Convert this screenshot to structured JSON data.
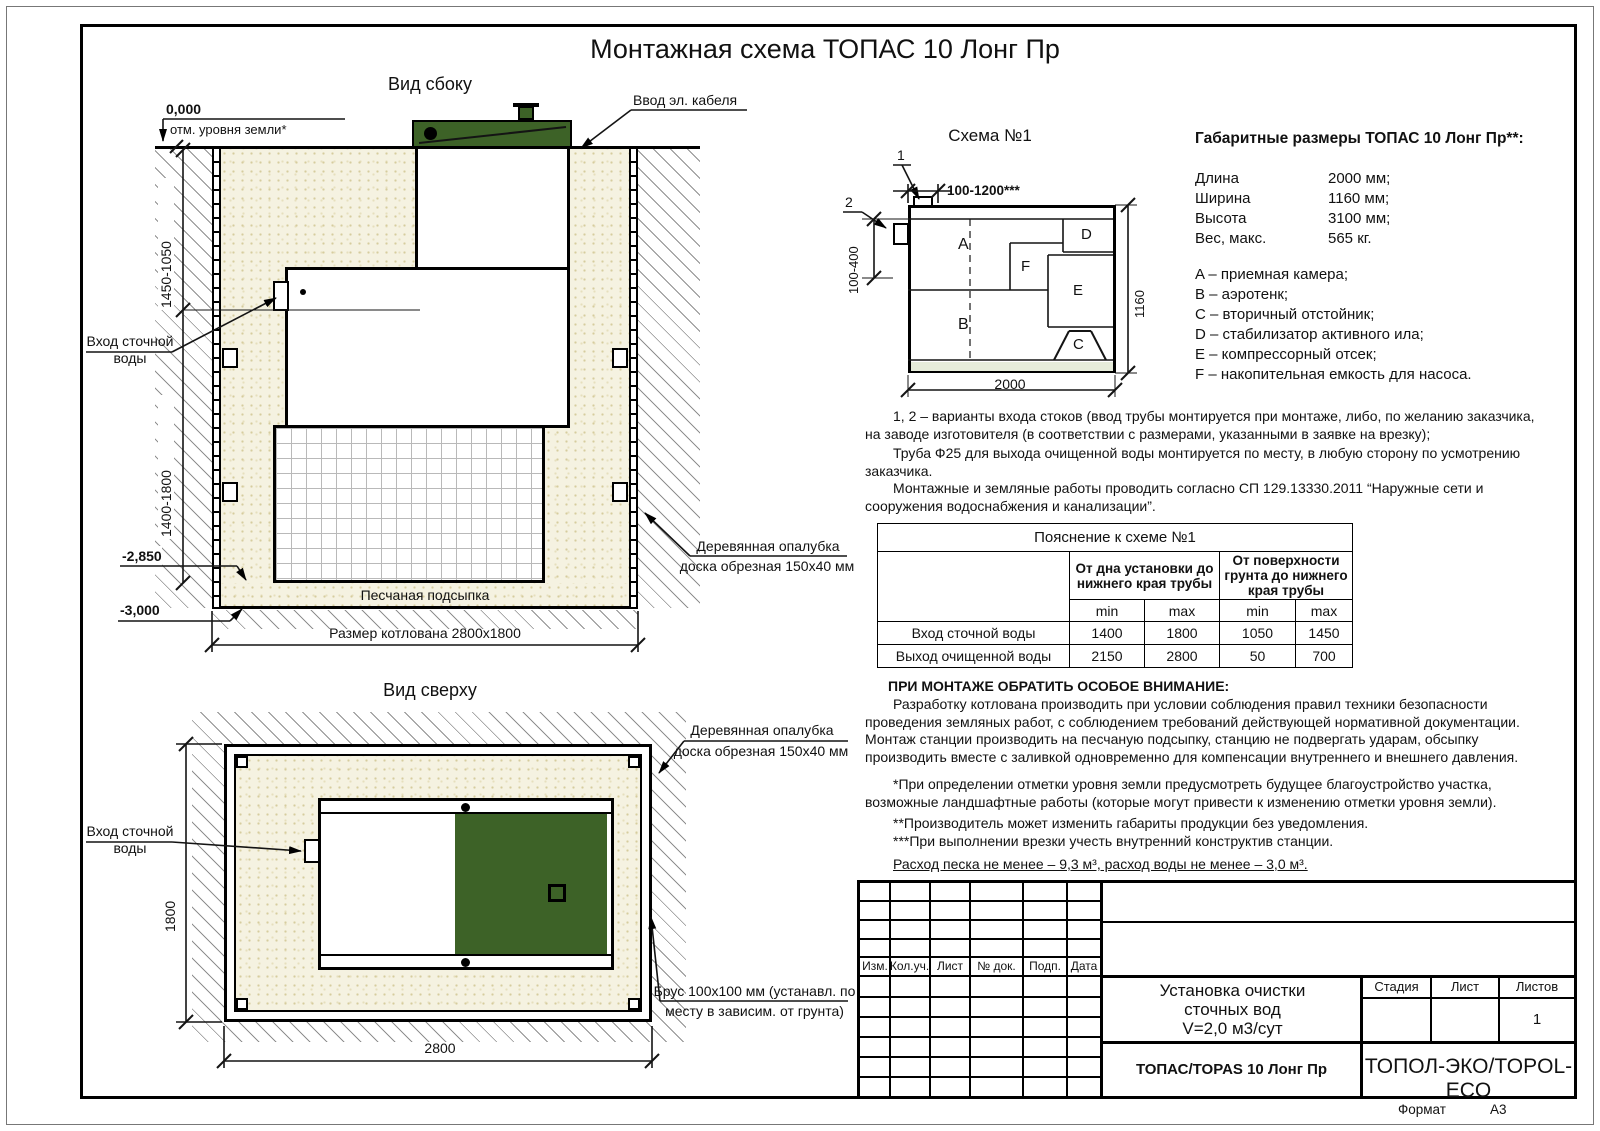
{
  "title": "Монтажная схема ТОПАС 10 Лонг Пр",
  "colors": {
    "green": "#3d6227",
    "sand": "#f5f2e1"
  },
  "side_view": {
    "label": "Вид сбоку",
    "zero_mark": "0,000",
    "ground_note": "отм. уровня земли*",
    "cable_label": "Ввод эл. кабеля",
    "inlet_label_1": "Вход сточной",
    "inlet_label_2": "воды",
    "dim_upper": "1450-1050",
    "dim_lower": "1400-1800",
    "level_1": "-2,850",
    "level_2": "-3,000",
    "sand_label": "Песчаная подсыпка",
    "pit_label": "Размер котлована 2800х1800",
    "formwork_label_1": "Деревянная опалубка",
    "formwork_label_2": "доска обрезная 150х40 мм"
  },
  "top_view": {
    "label": "Вид сверху",
    "inlet_label_1": "Вход сточной",
    "inlet_label_2": "воды",
    "dim_width": "1800",
    "dim_length": "2800",
    "formwork_label_1": "Деревянная опалубка",
    "formwork_label_2": "доска обрезная 150х40 мм",
    "beam_label_1": "Брус 100х100 мм (устанавл. по",
    "beam_label_2": "месту в зависим. от грунта)"
  },
  "schema": {
    "title": "Схема №1",
    "callout_1": "1",
    "callout_2": "2",
    "dim_top": "100-1200***",
    "dim_left": "100-400",
    "dim_right": "1160",
    "dim_bottom": "2000",
    "compartments": [
      "A",
      "B",
      "C",
      "D",
      "E",
      "F"
    ]
  },
  "dimensions": {
    "title": "Габаритные размеры ТОПАС 10 Лонг Пр**:",
    "rows": [
      {
        "label": "Длина",
        "value": "2000 мм;"
      },
      {
        "label": "Ширина",
        "value": "1160 мм;"
      },
      {
        "label": "Высота",
        "value": "3100 мм;"
      },
      {
        "label": "Вес, макс.",
        "value": "565 кг."
      }
    ],
    "legend": [
      "A – приемная камера;",
      "B – аэротенк;",
      "C – вторичный отстойник;",
      "D – стабилизатор активного ила;",
      "E – компрессорный отсек;",
      "F – накопительная емкость для насоса."
    ]
  },
  "notes": {
    "variants": "1, 2 – варианты входа  стоков (ввод трубы монтируется при монтаже, либо, по желанию заказчика, на заводе изготовителя (в соответствии с размерами, указанными в заявке на врезку);",
    "pipe": "Труба Ф25 для выхода очищенной воды монтируется по месту, в любую сторону по усмотрению заказчика.",
    "works": "Монтажные и земляные работы проводить согласно СП 129.13330.2011 “Наружные сети и сооружения водоснабжения и канализации”.",
    "attention_title": "ПРИ МОНТАЖЕ ОБРАТИТЬ ОСОБОЕ ВНИМАНИЕ:",
    "attention_body": "Разработку котлована производить при условии соблюдения правил техники безопасности проведения земляных работ, с соблюдением требований действующей нормативной документации. Монтаж станции производить на песчаную подсыпку, станцию не подвергать ударам, обсыпку производить вместе с заливкой одновременно для компенсации внутреннего и внешнего давления.",
    "star1": "*При определении отметки уровня земли предусмотреть будущее благоустройство участка, возможные ландшафтные работы (которые могут привести к изменению отметки уровня земли).",
    "star2": "**Производитель может изменить габариты продукции без уведомления.",
    "star3": "***При выполнении врезки учесть внутренний конструктив станции.",
    "consumption": "Расход песка не менее – 9,3 м³, расход воды не менее – 3,0 м³."
  },
  "table": {
    "title": "Пояснение к схеме №1",
    "col_group_1": "От дна установки до нижнего края трубы",
    "col_group_2": "От поверхности грунта до нижнего края трубы",
    "min_label": "min",
    "max_label": "max",
    "rows": [
      {
        "label": "Вход сточной воды",
        "values": [
          "1400",
          "1800",
          "1050",
          "1450"
        ]
      },
      {
        "label": "Выход очищенной воды",
        "values": [
          "2150",
          "2800",
          "50",
          "700"
        ]
      }
    ]
  },
  "title_block": {
    "columns": [
      "Изм.",
      "Кол.уч.",
      "Лист",
      "№ док.",
      "Подп.",
      "Дата"
    ],
    "doc_title_line1": "Установка очистки",
    "doc_title_line2": "сточных вод",
    "doc_title_line3": "V=2,0 м3/сут",
    "stage_label": "Стадия",
    "sheet_label": "Лист",
    "sheets_label": "Листов",
    "sheets_value": "1",
    "model": "ТОПАС/TOPAS 10 Лонг Пр",
    "company": "ТОПОЛ-ЭКО/TOPOL-ECO",
    "format_label": "Формат",
    "format_value": "А3"
  }
}
